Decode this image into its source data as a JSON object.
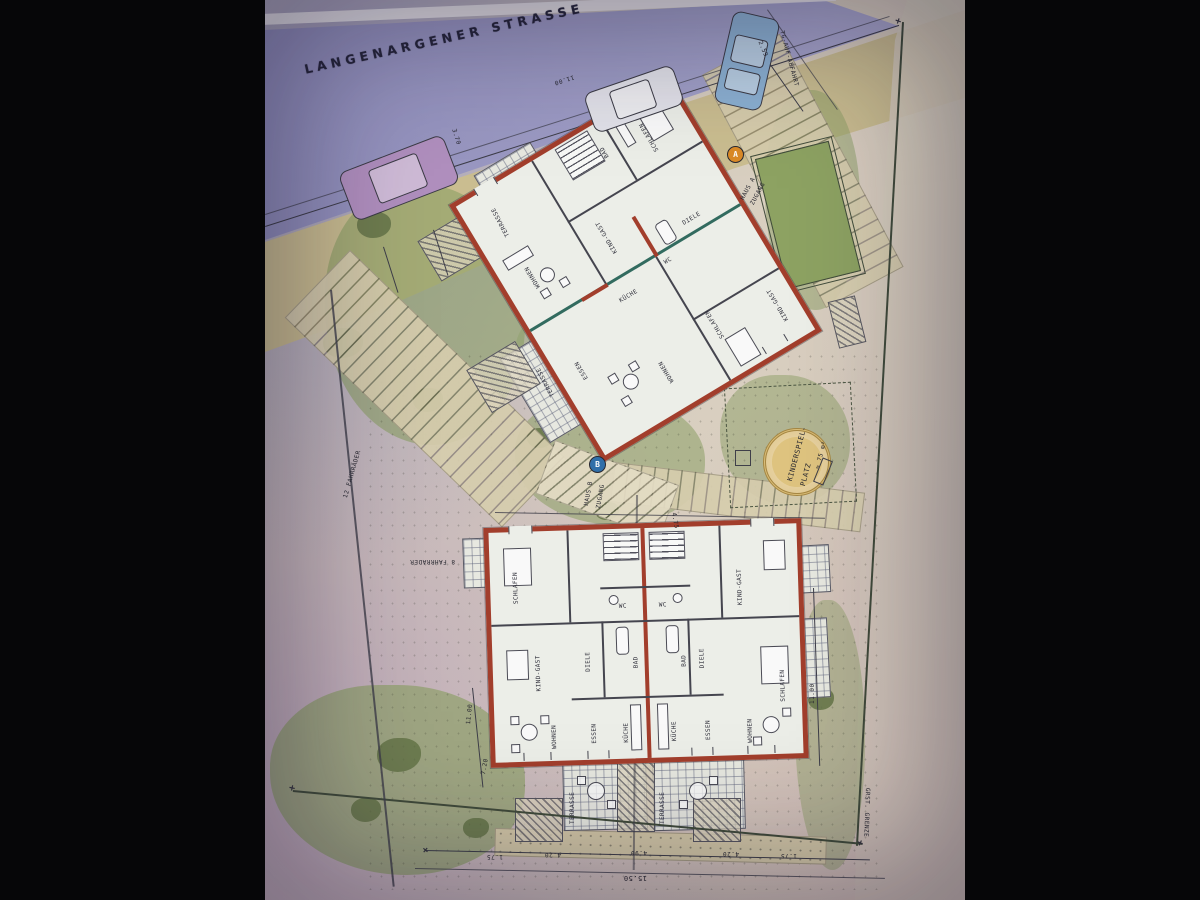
{
  "street": {
    "name": "LANGENARGENER STRASSE"
  },
  "labels": {
    "tg_ramp": "TG-AUF-ABFAHRT",
    "kinder_line1": "KINDERSPIEL-",
    "kinder_line2": "PLATZ",
    "kinder_area": "≈ 75 m²",
    "haus_a_line1": "HAUS A",
    "haus_a_line2": "ZUGANG",
    "marker_a": "A",
    "haus_b_line1": "HAUS B",
    "haus_b_line2": "ZUGANG",
    "marker_b": "B",
    "bikes12": "12 FAHRRÄDER",
    "bikes8": "8 FAHRRÄDER",
    "grenze": "GRST. GRENZE"
  },
  "dims": {
    "street": "11.00",
    "ramp": "2.59",
    "front": "3.70",
    "walk": "4.75",
    "right": "11.00",
    "left": "11.00",
    "path": "7.20",
    "seg1": "1.75",
    "seg2": "4.20",
    "seg3": "4.90",
    "seg4": "4.20",
    "seg5": "1.75",
    "total": "15.50"
  },
  "haus_a": {
    "rooms": [
      "SCHLAFEN",
      "KIND-GAST",
      "WOHNEN",
      "DIELE",
      "ESSEN",
      "BAD",
      "WC",
      "WOHNEN",
      "SCHLAFEN",
      "KIND-GAST",
      "KÜCHE"
    ],
    "terrasse": "TERRASSE"
  },
  "haus_b": {
    "left": [
      "SCHLAFEN",
      "DIELE",
      "KIND-GAST",
      "WC",
      "BAD",
      "KÜCHE",
      "ESSEN",
      "WOHNEN",
      "TERRASSE"
    ],
    "right": [
      "DIELE",
      "KIND-GAST",
      "SCHLAFEN",
      "WC",
      "BAD",
      "KÜCHE",
      "ESSEN",
      "WOHNEN",
      "TERRASSE"
    ]
  },
  "colors": {
    "wall_red": "#a83b28",
    "street_lavender": "#9694c4",
    "parking_tan": "#ccbe8d",
    "garden_green": "#8ba061",
    "paper": "#eef0ea",
    "ink": "#3c3c48",
    "marker_a_orange": "#e08a1e",
    "marker_b_blue": "#2b6fae",
    "car_blue": "#8ab2d6",
    "car_purple": "#b28fc2",
    "car_silver": "#e4e4ec",
    "sand": "#dcbc6d"
  }
}
